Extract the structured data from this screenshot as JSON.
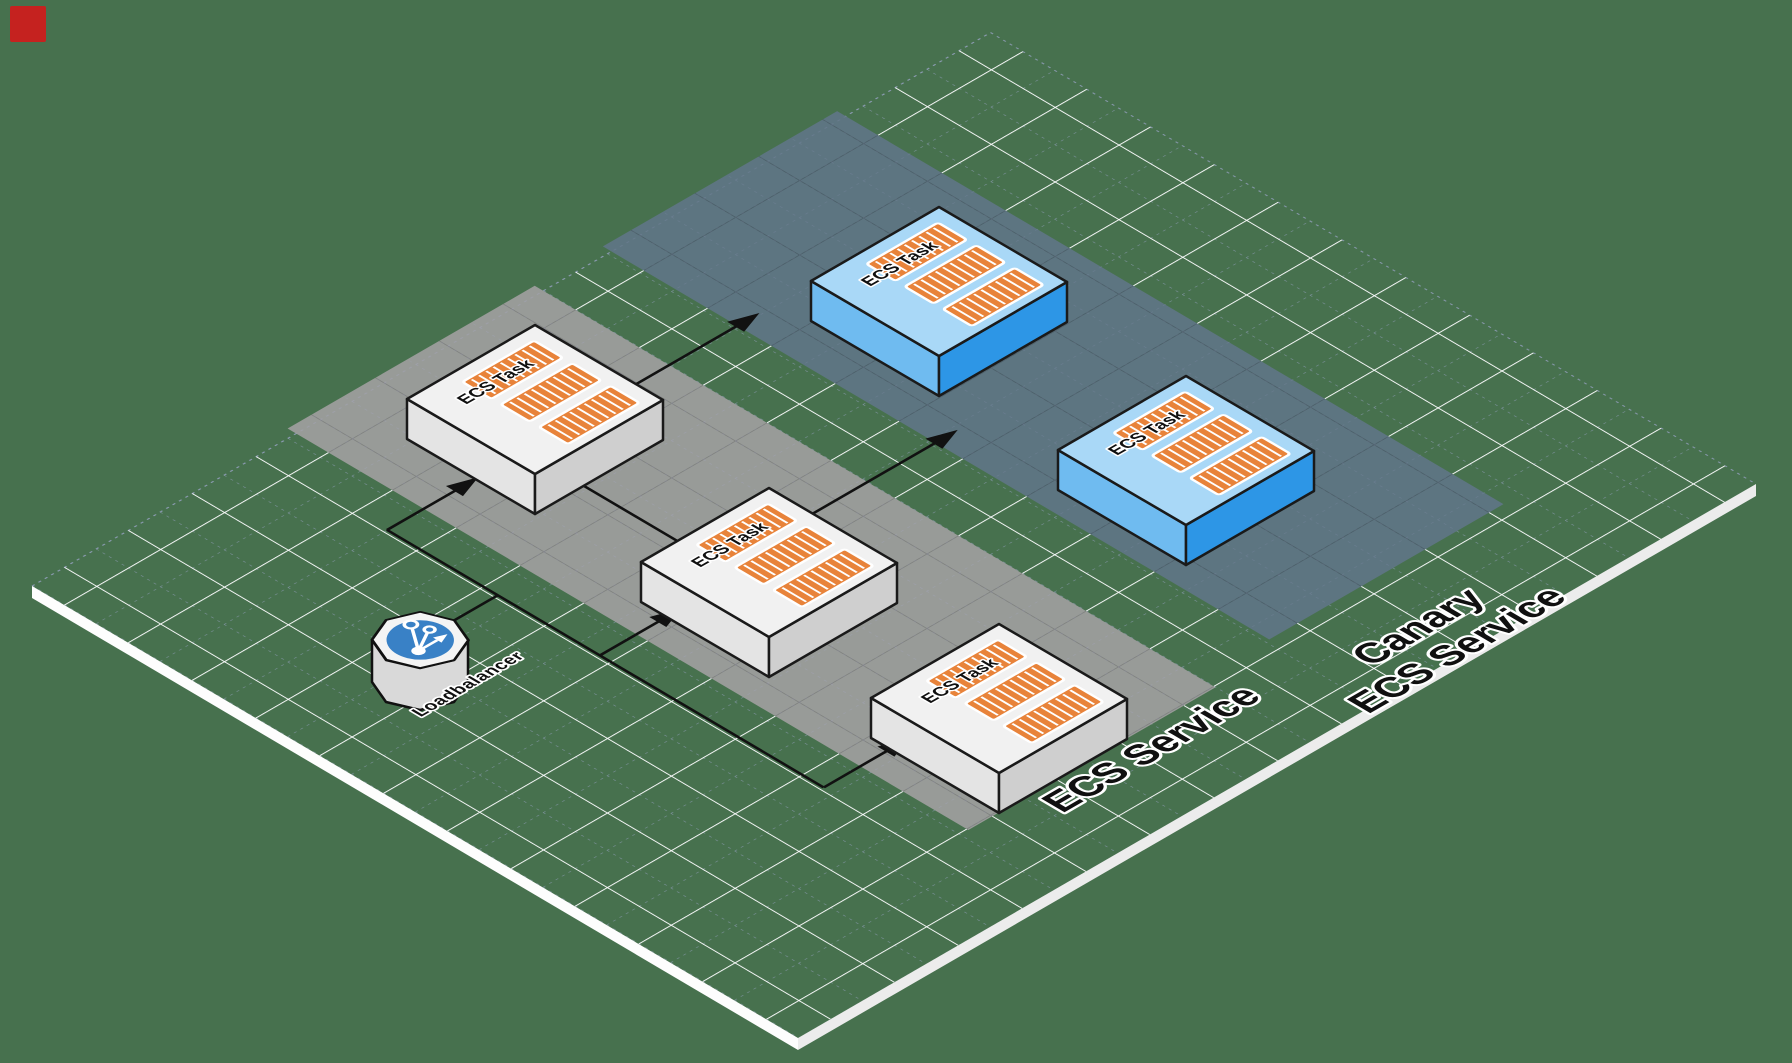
{
  "scene": {
    "background_color": "#47714E",
    "grid_major_color": "#FFFFFF",
    "grid_minor_color": "#A6ABD8",
    "connector_color": "#111111",
    "marker_color": "#C5221F"
  },
  "loadbalancer": {
    "label": "Loadbalancer",
    "icon": "load-balancer-share-icon",
    "icon_color": "#3981C6"
  },
  "services": [
    {
      "label": "ECS Service",
      "band_color": "#9E9E9E",
      "task_top_color": "#F1F1F1",
      "tasks": [
        {
          "label": "ECS Task",
          "icon": "container-icon",
          "container_color": "#E8833A"
        },
        {
          "label": "ECS Task",
          "icon": "container-icon",
          "container_color": "#E8833A"
        },
        {
          "label": "ECS Task",
          "icon": "container-icon",
          "container_color": "#E8833A"
        }
      ]
    },
    {
      "label_line1": "Canary",
      "label_line2": "ECS Service",
      "band_color": "#5F7584",
      "task_top_color": "#A9D8F7",
      "tasks": [
        {
          "label": "ECS Task",
          "icon": "container-icon",
          "container_color": "#E8833A"
        },
        {
          "label": "ECS Task",
          "icon": "container-icon",
          "container_color": "#E8833A"
        }
      ]
    }
  ]
}
